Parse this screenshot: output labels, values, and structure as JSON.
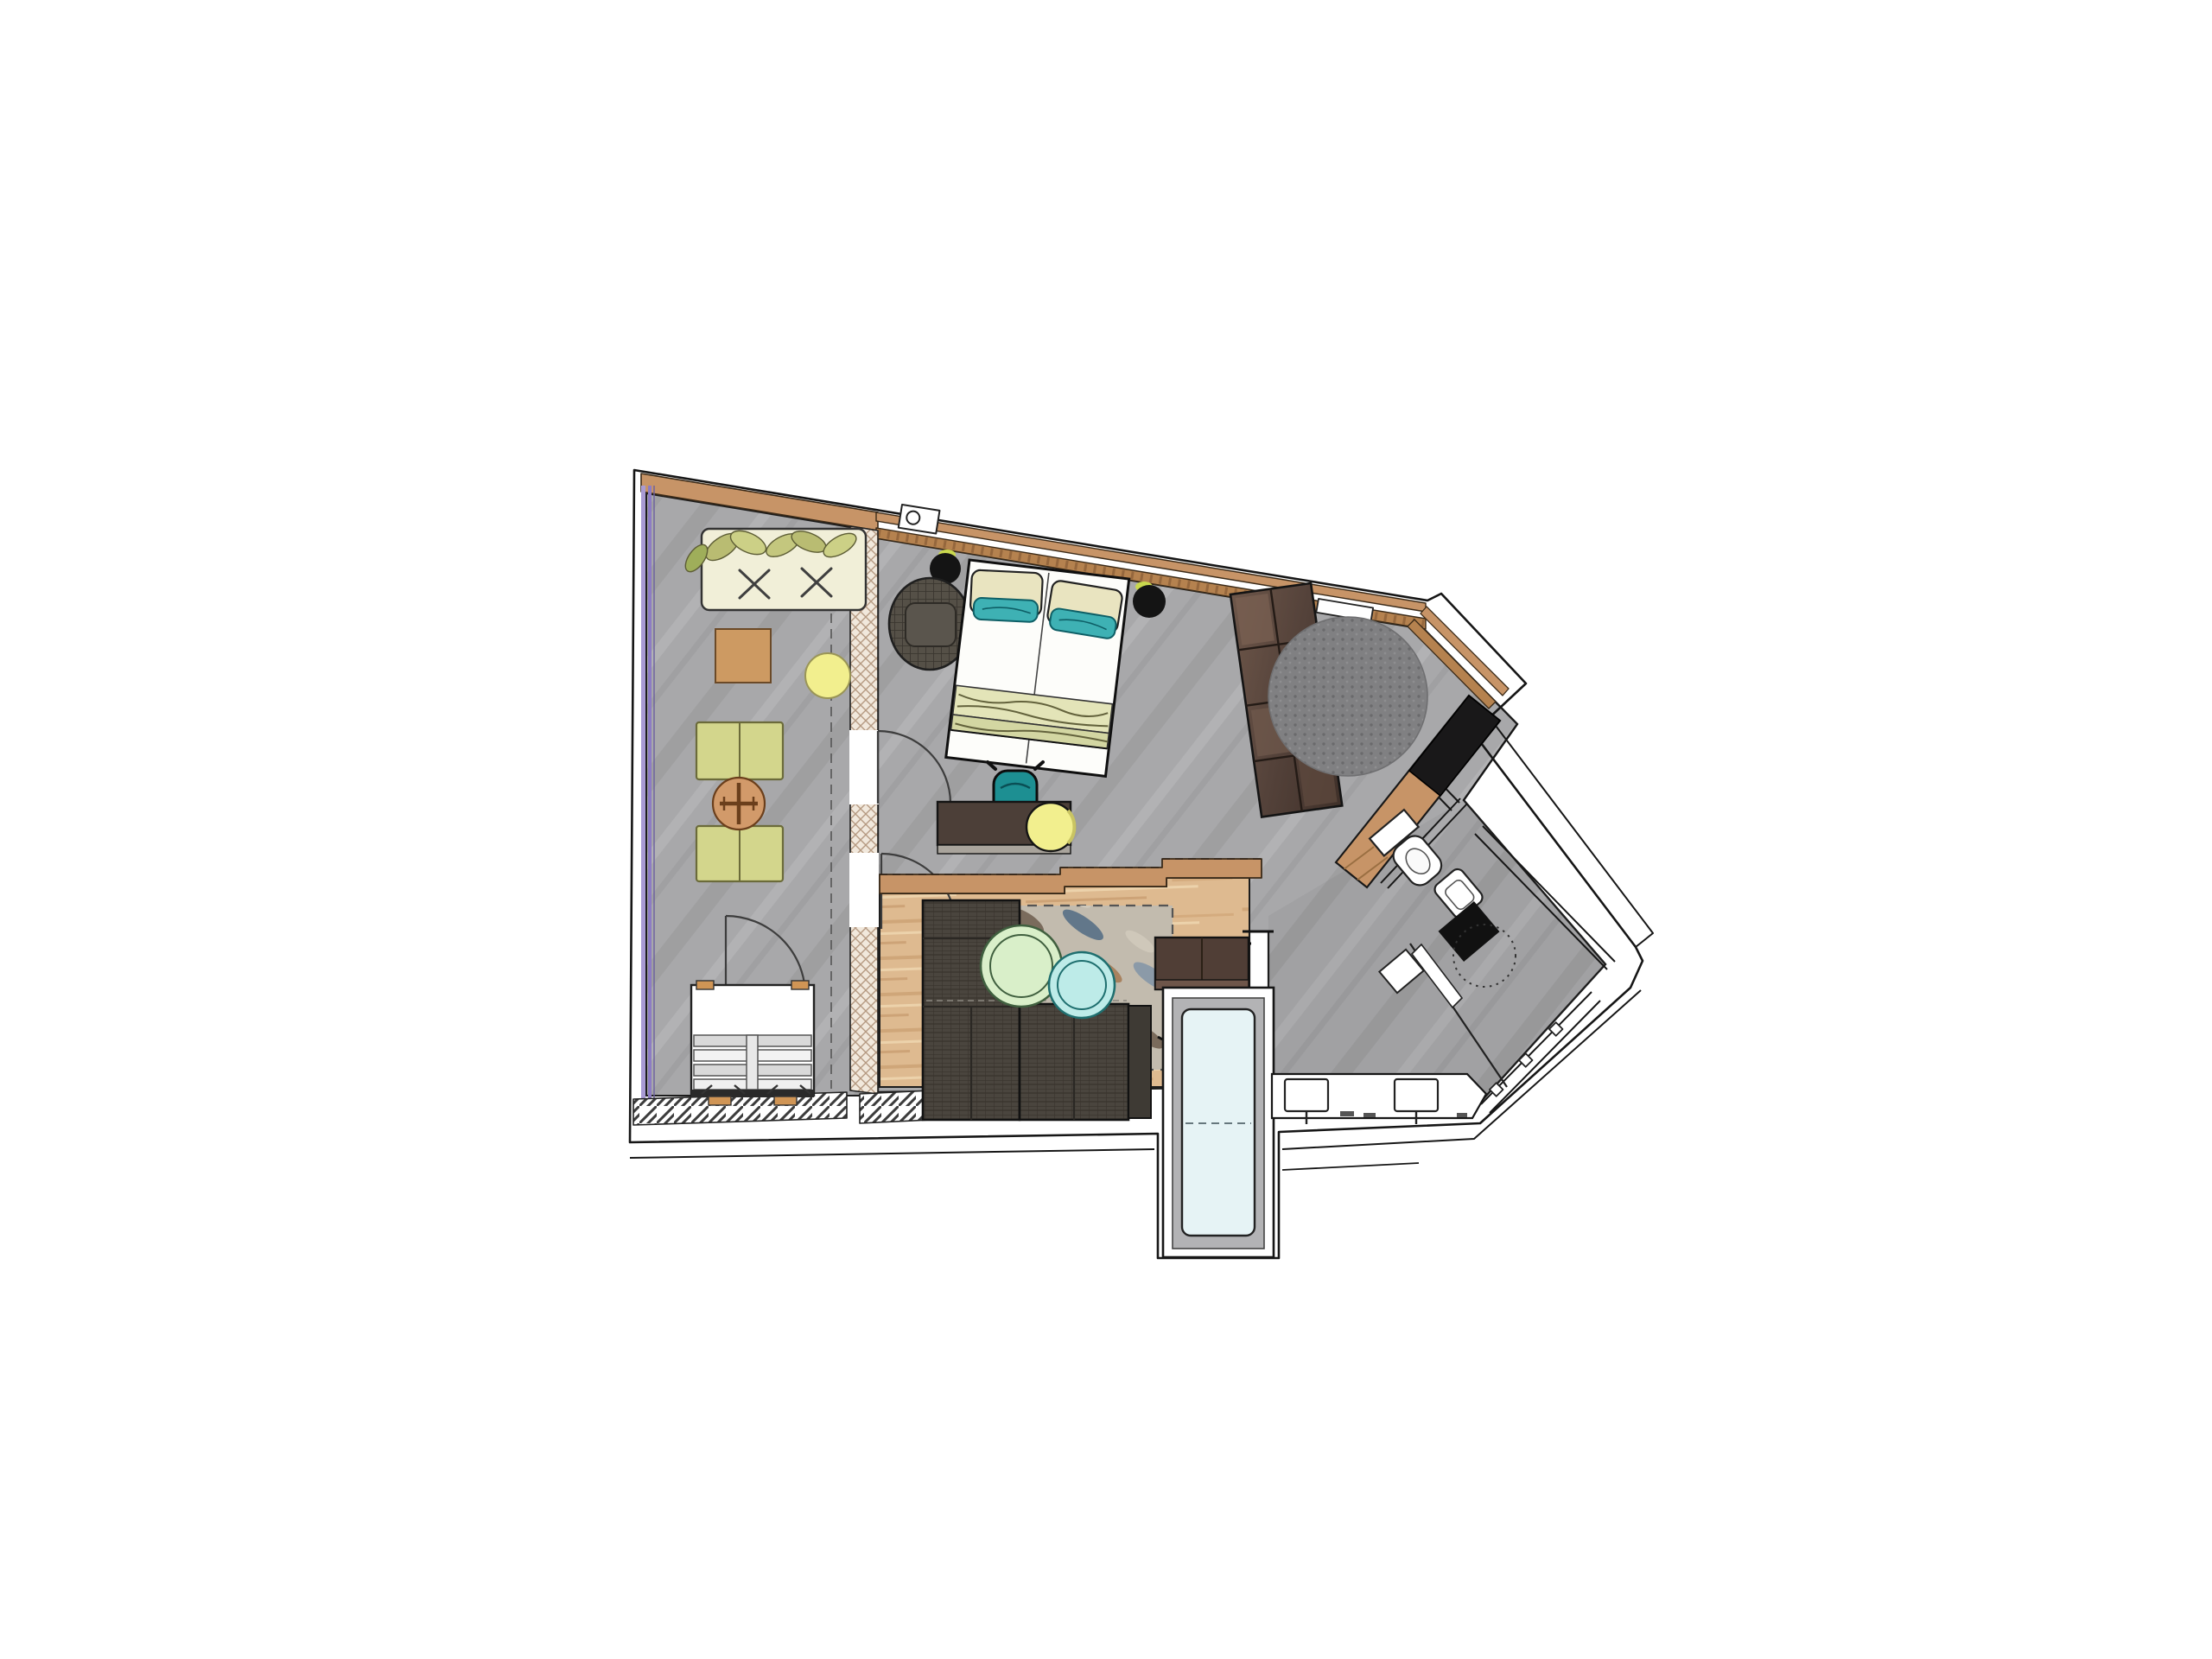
{
  "document": {
    "type": "floor-plan",
    "subject": "hotel-suite-floor-plan-top-view",
    "background": "#ffffff"
  },
  "palette": {
    "wall_line": "#1c1c1c",
    "floor_concrete": "#a8a8aa",
    "floor_concrete_streak": "#9c9c9e",
    "floor_concrete_light": "#b4b4b6",
    "floor_wood": "#deba90",
    "wood_streak_dark": "#cda276",
    "wood_streak_light": "#ecd2ab",
    "wood_trim": "#c79467",
    "wood_trim_dark": "#b5824f",
    "glazing_purple_light": "#a99bd4",
    "glazing_purple_dark": "#8d7cc4",
    "insulation_fill": "#f1e8dc",
    "insulation_hatch": "#b59a82",
    "daybed_base": "#f1efd8",
    "cushion_olive": "#b9bc72",
    "cushion_olive_light": "#ccd086",
    "lounger_green": "#d3d68c",
    "lounger_edge": "#6b6b3a",
    "bistro_table_orange": "#d29a6a",
    "bistro_symbol": "#6b3f1c",
    "side_table_wood": "#cd9a62",
    "stool_yellow": "#f2ef8e",
    "stool_ring": "#9a9556",
    "wicker_base": "#555047",
    "wicker_line": "#3a362f",
    "bed_linen": "#fdfdfa",
    "pillow_cream": "#e9e4c0",
    "pillow_teal": "#3eb1b4",
    "pillow_teal_dark": "#0e5f66",
    "throw_band_a": "#e3e4b8",
    "throw_band_b": "#d3d6a2",
    "throw_wave": "#63623c",
    "pendant_black": "#141414",
    "pendant_glint": "#c9d84e",
    "wardrobe_dark": "#54423a",
    "wardrobe_light": "#72594c",
    "rug_round_gray": "#808082",
    "rug_round_dot": "#6a6a6c",
    "sideboard_black": "#191819",
    "desk_brown": "#4c3f38",
    "desk_edge": "#a9a49c",
    "chair_teal": "#1d8f92",
    "sofa_base": "#4a453e",
    "sofa_line": "#38332c",
    "sofa_seam": "#2b2824",
    "settee_brown": "#503e36",
    "settee_edge": "#6e564a",
    "rug_mottled_base": "#c2bbae",
    "blob_blue": "#8b9aa8",
    "blob_brown": "#7a6b5c",
    "blob_rust": "#a8825f",
    "blob_cream": "#cfc8ba",
    "blob_slate": "#62778a",
    "table_green_fill": "#d9efc9",
    "table_green_ring": "#40603f",
    "table_cyan_fill": "#bdebe8",
    "table_cyan_ring": "#1f6f6f",
    "tub_water": "#e6f3f5",
    "tub_deck": "#b3b3b5",
    "fixture_white": "#ffffff",
    "hatch_dark": "#3c3c3c"
  },
  "rooms": [
    {
      "id": "balcony",
      "label": "balcony-loggia",
      "furniture": [
        "daybed-with-olive-cushions",
        "wooden-side-table",
        "double-sun-lounger-upper",
        "double-sun-lounger-lower",
        "round-bistro-table",
        "yellow-stool",
        "slatted-storage-bench",
        "balcony-door"
      ]
    },
    {
      "id": "sleeping-area",
      "label": "sleeping-area",
      "furniture": [
        "double-bed",
        "pendant-lamp-left",
        "pendant-lamp-right",
        "wicker-lounge-chair",
        "wardrobe-shelf-unit",
        "round-gray-rug",
        "desk",
        "teal-desk-chair",
        "yellow-pouf"
      ]
    },
    {
      "id": "living-area",
      "label": "living-area",
      "furniture": [
        "l-shaped-sofa",
        "mottled-area-rug",
        "round-coffee-table-green",
        "round-coffee-table-cyan",
        "settee-bench",
        "stepped-console-band"
      ]
    },
    {
      "id": "bathroom",
      "label": "bathroom",
      "furniture": [
        "bathtub-window-bay",
        "double-sink-vanity",
        "toilet",
        "bidet",
        "shower-black-pad",
        "shower-drain-dotted",
        "glass-screen"
      ]
    },
    {
      "id": "entry",
      "label": "entry-hall",
      "furniture": [
        "angled-sideboard-wood-black"
      ]
    }
  ]
}
